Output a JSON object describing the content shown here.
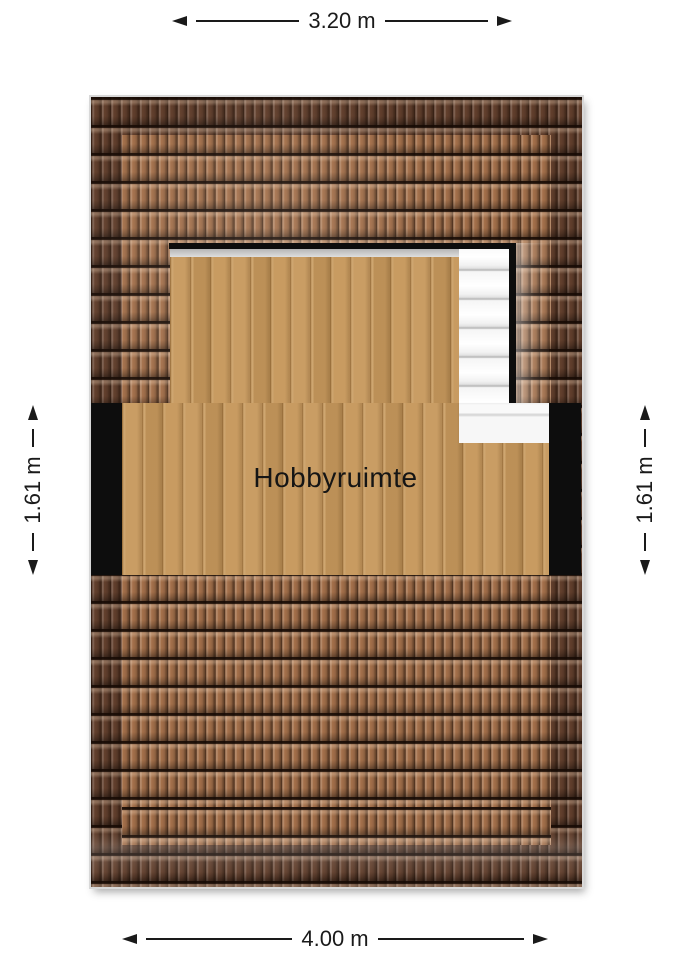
{
  "floor_plan": {
    "room": {
      "label": "Hobbyruimte"
    },
    "dimensions": {
      "top": {
        "label": "3.20 m"
      },
      "bottom": {
        "label": "4.00 m"
      },
      "left": {
        "label": "1.61 m"
      },
      "right": {
        "label": "1.61 m"
      }
    },
    "colors": {
      "background": "#ffffff",
      "tile_dark": "#63402d",
      "tile_light": "#a5714b",
      "wood": "#c6985c",
      "wall": "#0d0d0d",
      "stair": "#f7f7f7",
      "dimension_line": "#1a1a1a"
    }
  }
}
